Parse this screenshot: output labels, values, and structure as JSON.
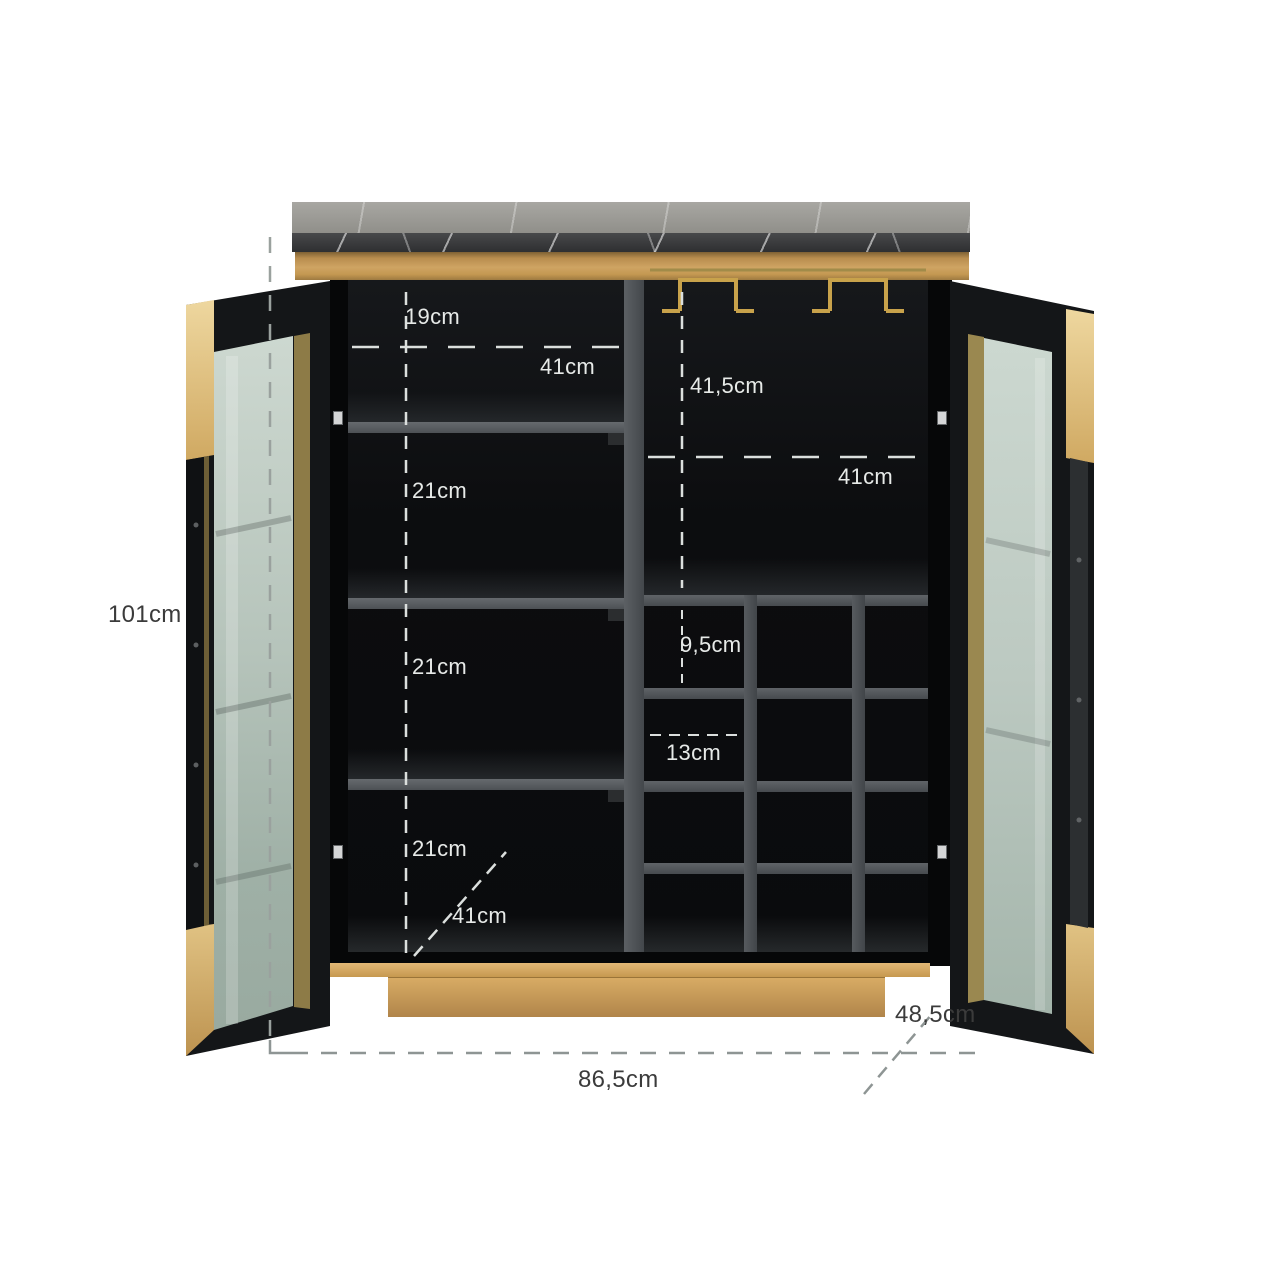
{
  "diagram": {
    "title": "Bar cabinet dimension diagram",
    "object": "Two-door bar cabinet with black marble top, brushed gold frame, glass doors, four interior shelves and a wine-bottle rack",
    "materials": {
      "top": "black marble",
      "frame": "gold / brass",
      "doors": "black steel with tinted glass",
      "interior": "black with grey shelves"
    }
  },
  "dimension_labels": {
    "overall_height": "101cm",
    "overall_width": "86,5cm",
    "overall_depth": "48,5cm",
    "top_section_height": "19cm",
    "left_compartment_width": "41cm",
    "right_top_compartment_height": "41,5cm",
    "right_compartment_width": "41cm",
    "shelf_gap_1": "21cm",
    "shelf_gap_2": "21cm",
    "shelf_gap_3": "21cm",
    "wine_slot_height": "9,5cm",
    "wine_slot_width": "13cm",
    "interior_depth": "41cm"
  },
  "colors": {
    "background": "#ffffff",
    "gold": "#c89a55",
    "gold_light": "#e8d09a",
    "marble_top": "#9a9994",
    "marble_edge": "#37383a",
    "interior_black": "#0c0d0f",
    "shelf_grey": "#53585c",
    "glass_green": "#bfccc4",
    "label_light": "#e7eae8",
    "label_dark": "#3b3b3b"
  }
}
